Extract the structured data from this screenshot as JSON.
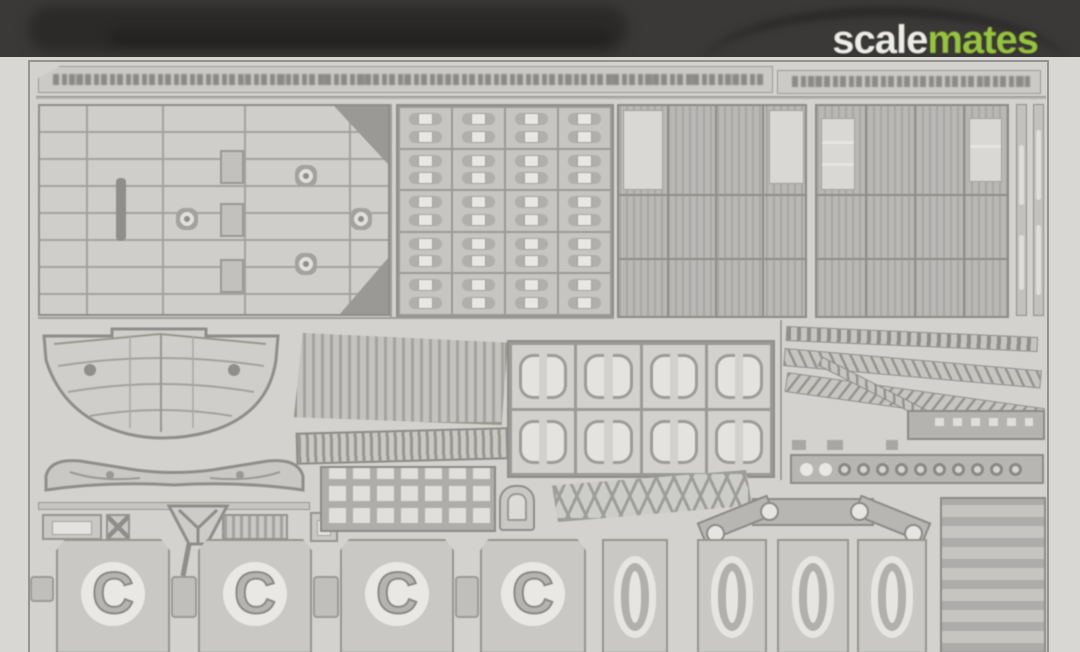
{
  "watermark": {
    "part1": "scale",
    "part2": "mates"
  },
  "colors": {
    "watermark_part1": "#ededea",
    "watermark_part2": "#96c43c",
    "header_band": "#3b3937",
    "photo_background": "#d8d7d4",
    "fret_plate": "#d3d2cf",
    "etch_line": "#8f8e8b",
    "panel_rib": "#b9b8b5"
  },
  "fret_parts": {
    "c_labels": [
      "C",
      "C",
      "C",
      "C"
    ]
  }
}
